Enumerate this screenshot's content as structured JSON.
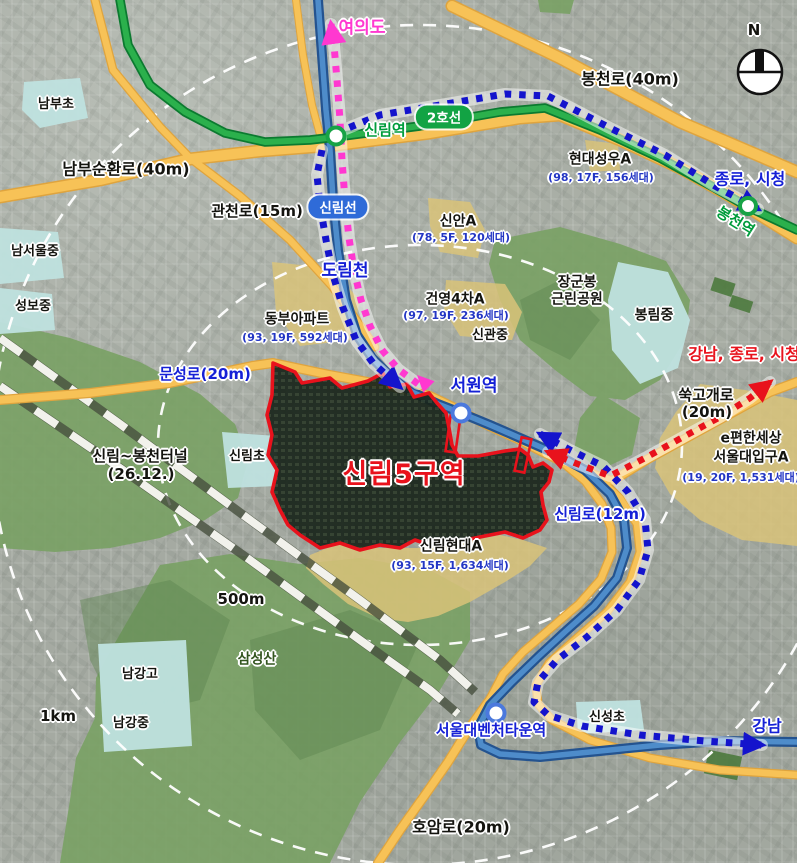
{
  "compass": {
    "label": "N"
  },
  "district": {
    "name": "신림5구역",
    "outline_color": "#e8121c"
  },
  "river": {
    "name": "도림천"
  },
  "tunnel": {
    "name": "신림~봉천터널",
    "note": "(26.12.)"
  },
  "scale_rings": [
    {
      "label": "500m"
    },
    {
      "label": "1km"
    }
  ],
  "line_badges": [
    {
      "name": "2호선",
      "bg": "#12a344"
    },
    {
      "name": "신림선",
      "bg": "#2f6bd8"
    }
  ],
  "stations": [
    {
      "name": "신림역",
      "color": "#009c3c"
    },
    {
      "name": "봉천역",
      "color": "#009c3c"
    },
    {
      "name": "서원역",
      "color": "#1520d6"
    },
    {
      "name": "서울대벤처타운역",
      "color": "#1520d6"
    }
  ],
  "roads": [
    {
      "label": "봉천로(40m)"
    },
    {
      "label": "남부순환로(40m)"
    },
    {
      "label": "관천로(15m)"
    },
    {
      "label": "문성로(20m)"
    },
    {
      "label": "쑥고개로",
      "label2": "(20m)"
    },
    {
      "label": "신림로(12m)"
    },
    {
      "label": "호암로(20m)"
    }
  ],
  "destinations": [
    {
      "name": "여의도",
      "color": "#ff38d0"
    },
    {
      "name": "종로, 시청",
      "color": "#1520d6"
    },
    {
      "name": "강남, 종로, 시청",
      "color": "#e8121c"
    },
    {
      "name": "강남",
      "color": "#1520d6"
    }
  ],
  "apartments": [
    {
      "name": "현대성우A",
      "detail": "(98, 17F, 156세대)"
    },
    {
      "name": "신안A",
      "detail": "(78, 5F, 120세대)"
    },
    {
      "name": "건영4차A",
      "detail": "(97, 19F, 236세대)"
    },
    {
      "name": "동부아파트",
      "detail": "(93, 19F, 592세대)"
    },
    {
      "name": "신림현대A",
      "detail": "(93, 15F, 1,634세대)"
    },
    {
      "name": "e편한세상",
      "name2": "서울대입구A",
      "detail": "(19, 20F, 1,531세대)"
    }
  ],
  "schools": [
    "남부초",
    "남서울중",
    "성보중",
    "신림초",
    "신관중",
    "봉림중",
    "남강고",
    "남강중",
    "신성초"
  ],
  "parks": [
    {
      "name": "장군봉",
      "name2": "근린공원"
    },
    {
      "name": "삼성산"
    }
  ],
  "colors": {
    "road_yellow": "#f7c257",
    "line2_green": "#2bb04c",
    "river_blue": "#4e8cca",
    "route_blue": "#1414cc",
    "route_pink": "#ff38d0",
    "route_red": "#e8121c",
    "school_zone": "#bfe2df",
    "apartment_zone": "#d9c379",
    "park_green": "#79a164"
  }
}
